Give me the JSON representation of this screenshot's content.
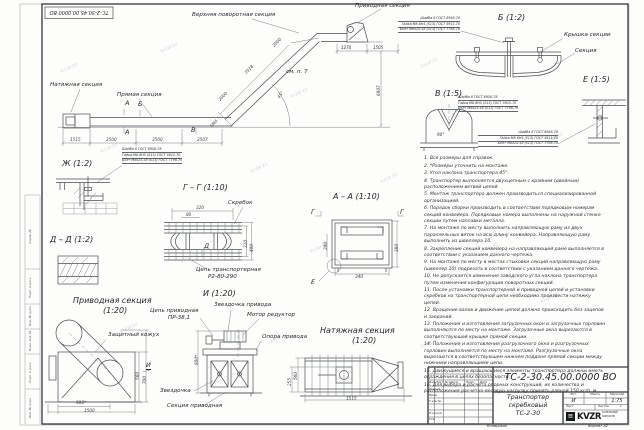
{
  "watermark": "kvzar.kz",
  "stamp": "ТС-2-30.45.00.0000 ВО",
  "main": {
    "upper_turn_label": "Верхняя поворотная секция",
    "drive_label": "Приводная секция",
    "tension_label": "Натяжная секция",
    "straight_label": "Прямая секция",
    "see_note": "см. п. 7",
    "angle": "45°",
    "mark_a": "А",
    "mark_b": "Б",
    "mark_v": "В",
    "dim_1515": "1515",
    "dim_3500a": "3500",
    "dim_3500b": "3500",
    "dim_2507": "2507",
    "dim_i1": "2000",
    "dim_i2": "3518",
    "dim_i3": "2000",
    "dim_bend": "1865",
    "dim_t1": "1270",
    "dim_t2": "1505",
    "dim_h": "6907"
  },
  "callout": {
    "line1": "Шайба 8 ГОСТ 6958-78",
    "line2": "Гайка М8-6Н5 (S13) ГОСТ 5915-70",
    "line3": "Болт М8х25.58 (S13) ГОСТ 7798-70"
  },
  "view_zh": {
    "title": "Ж (1:2)"
  },
  "view_gg": {
    "title": "Г – Г (1:10)",
    "scraper": "Скребок",
    "chain1": "Цепь транспортерная",
    "chain2": "Р2-80-290",
    "mark_d": "Д",
    "dim_320": "320",
    "dim_80": "80",
    "dim_r320": "320",
    "dim_r400": "400"
  },
  "view_dd": {
    "title": "Д – Д (1:2)"
  },
  "view_aa": {
    "title": "А – А (1:10)",
    "mark_g": "Г",
    "mark_e": "Е",
    "dim_200": "200",
    "dim_380": "380",
    "dim_340": "340"
  },
  "view_b": {
    "title": "Б (1:2)",
    "cover": "Крышка секции",
    "section": "Секция"
  },
  "view_v": {
    "title": "В (1:5)",
    "dim_angle": "90°"
  },
  "view_e": {
    "title": "Е (1:5)"
  },
  "view_drive": {
    "title": "Приводная секция",
    "scale": "(1:20)",
    "cover": "Защитный кожух",
    "mark_i": "И",
    "dim_900": "900*",
    "dim_1500": "1500",
    "dim_560": "560",
    "dim_700": "700"
  },
  "view_i": {
    "title": "И (1:20)",
    "chain1": "Цепь приводная",
    "chain2": "ПР-38,1",
    "sprocket_drive": "Звездочка привода",
    "motor": "Мотор редуктор",
    "support": "Опора привода",
    "sprocket": "Звездочка",
    "section": "Секция приводная",
    "dim_800": "800*"
  },
  "view_tension": {
    "title": "Натяжная секция",
    "scale": "(1:20)",
    "dim_560": "560",
    "dim_255": "255",
    "dim_1515": "1515"
  },
  "notes": [
    "1. Все размеры для справок.",
    "2. *Размеры уточнить на монтаже.",
    "3. Угол наклона транспортера 45°.",
    "4. Транспортер выполняется двухцепным с крайним (двойным) расположением ветвей цепей.",
    "5. Монтаж транспортера должен производиться специализированной организацией.",
    "6. Порядок сборки производить в соответствии порядковым номерам секций конвейера. Порядковые номера выполнены на наружной стенке секции путем наплавки металла.",
    "7. На монтаже по месту выполнить направляющую раму из двух параллельных веток на всю длину конвейера. Направляющую раму выполнить из швеллера 10.",
    "8. Закрепление секций конвейера на направляющей раме выполняется в соответствии с указанием данного чертежа.",
    "9. На монтаже по месту в местах стыковки секций направляющую раму (швеллер 10) подрезать в соответствии с указанием данного чертежа.",
    "10. Не допускается изменение заводского угла наклона транспортера путем изменения конфигурации поворотных секций.",
    "11. После установки транспортерной и приводной цепей и установки скребков на транспортерной цепи необходимо произвести натяжку цепей.",
    "12. Вращение валов и движение цепей должно происходить без зацепов и заеданий.",
    "13. Положения и изготовления загрузочных окон и загрузочных горловин выполняются по месту на монтаже. Загрузочные окна вырезаются в соответствующей крышке прямой секции.",
    "14. Положения и изготовления разгрузочного окна и разгрузочных горловин выполняется по месту на монтаже. Разгрузочные окна вырезаются в соответствующем нижнем поддоне прямой секции между нижними направляющими цепи.",
    "15. Движущиеся и вращающиеся элементы транспортера должны иметь ограждения в целях безопасности.",
    "16. Для выбора и расчета опорных конструкций, их количества и расположения расчетно-весовую нагрузку принять равной 150 кг/п. м."
  ],
  "title_block": {
    "designation": "ТС-2-30.45.00.0000 ВО",
    "doc_name_1": "Транспортер",
    "doc_name_2": "скребковый",
    "doc_name_3": "ТС-2-30",
    "lit_value": "И",
    "scale_value": "1:75",
    "h_lit": "Лит.",
    "h_mass": "Масса",
    "h_scale": "Масштаб",
    "h_sheet": "Лист",
    "h_sheets": "Листов",
    "sheets_value": "1",
    "col_change": "Изм.",
    "col_sheet": "Лист",
    "col_doc": "№ докум.",
    "col_sign": "Подп.",
    "col_date": "Дата",
    "row_dev": "Разраб.",
    "row_check": "Пров.",
    "row_tcontr": "Т.контр.",
    "row_ncontr": "Н.контр.",
    "row_approve": "Утв.",
    "logo": "KVZR",
    "logo_line1": "КОТЕЛЬНЫЙ",
    "logo_line2": "ЗАВОД РФ",
    "copied": "Копировал",
    "format": "Формат А2"
  },
  "frame": {
    "s1": "Справ. №",
    "s2": "Подп. и дата",
    "s3": "Инв. № дубл.",
    "s4": "Взам. инв. №",
    "s5": "Подп. и дата",
    "s6": "Инв. № подл."
  }
}
